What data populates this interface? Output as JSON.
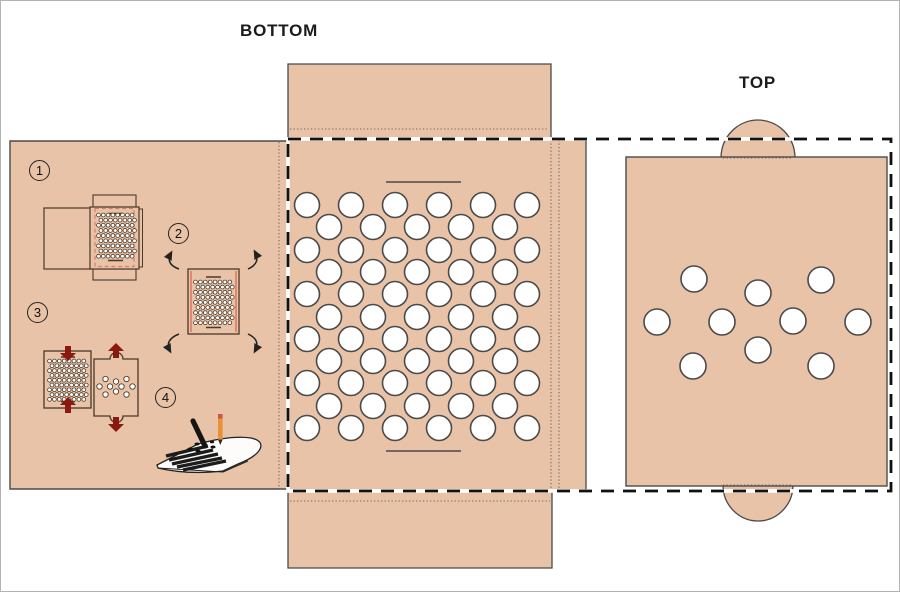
{
  "labels": {
    "bottom_panel": "BOTTOM",
    "top_panel": "TOP"
  },
  "steps": [
    {
      "number": "1"
    },
    {
      "number": "2"
    },
    {
      "number": "3"
    },
    {
      "number": "4"
    }
  ],
  "colors": {
    "card": "#e9c3a7",
    "hole_fill": "#ffffff",
    "outline": "#4a4a4a",
    "mini_outline": "#4a3828",
    "cut_dash": "#111111",
    "fold_dot": "#6a6a6a",
    "mini_red": "#de7a68",
    "arrow_red": "#8a1a0f",
    "pencil_orange": "#e59335",
    "pencil_eraser": "#c9574a",
    "marker_black": "#151515"
  },
  "bottom_panel": {
    "hole_radius": 12.5,
    "rows": [
      {
        "y": 204,
        "xs": [
          306,
          350,
          394,
          438,
          482,
          526
        ]
      },
      {
        "y": 226,
        "xs": [
          328,
          372,
          416,
          460,
          504
        ]
      },
      {
        "y": 249,
        "xs": [
          306,
          350,
          394,
          438,
          482,
          526
        ]
      },
      {
        "y": 271,
        "xs": [
          328,
          372,
          416,
          460,
          504
        ]
      },
      {
        "y": 293,
        "xs": [
          306,
          350,
          394,
          438,
          482,
          526
        ]
      },
      {
        "y": 316,
        "xs": [
          328,
          372,
          416,
          460,
          504
        ]
      },
      {
        "y": 338,
        "xs": [
          306,
          350,
          394,
          438,
          482,
          526
        ]
      },
      {
        "y": 360,
        "xs": [
          328,
          372,
          416,
          460,
          504
        ]
      },
      {
        "y": 382,
        "xs": [
          306,
          350,
          394,
          438,
          482,
          526
        ]
      },
      {
        "y": 405,
        "xs": [
          328,
          372,
          416,
          460,
          504
        ]
      },
      {
        "y": 427,
        "xs": [
          306,
          350,
          394,
          438,
          482,
          526
        ]
      }
    ]
  },
  "top_panel": {
    "hole_radius": 13,
    "holes": [
      [
        693,
        278
      ],
      [
        757,
        292
      ],
      [
        820,
        279
      ],
      [
        656,
        321
      ],
      [
        721,
        321
      ],
      [
        792,
        320
      ],
      [
        857,
        321
      ],
      [
        757,
        349
      ],
      [
        692,
        365
      ],
      [
        820,
        365
      ]
    ]
  },
  "mini_grids": {
    "step1": {
      "x0": 97.5,
      "y0": 214,
      "dx": 4.8,
      "dy": 5.15,
      "rows": 9,
      "cols": 8,
      "r": 1.9
    },
    "step2": {
      "x0": 194.5,
      "y0": 281,
      "dx": 4.9,
      "dy": 5.1,
      "rows": 9,
      "cols": 8,
      "r": 1.9
    },
    "step3_left": {
      "x0": 48.5,
      "y0": 360,
      "dx": 4.9,
      "dy": 4.8,
      "rows": 9,
      "cols": 8,
      "r": 1.9
    }
  },
  "mini_top_holes": {
    "r": 2.7,
    "pts": [
      [
        104.5,
        378
      ],
      [
        115,
        380.5
      ],
      [
        125.5,
        378
      ],
      [
        98.5,
        385.5
      ],
      [
        109,
        385.5
      ],
      [
        120.5,
        385.5
      ],
      [
        131.5,
        385.5
      ],
      [
        115,
        390.5
      ],
      [
        104.5,
        393.5
      ],
      [
        125.5,
        393.5
      ]
    ]
  }
}
